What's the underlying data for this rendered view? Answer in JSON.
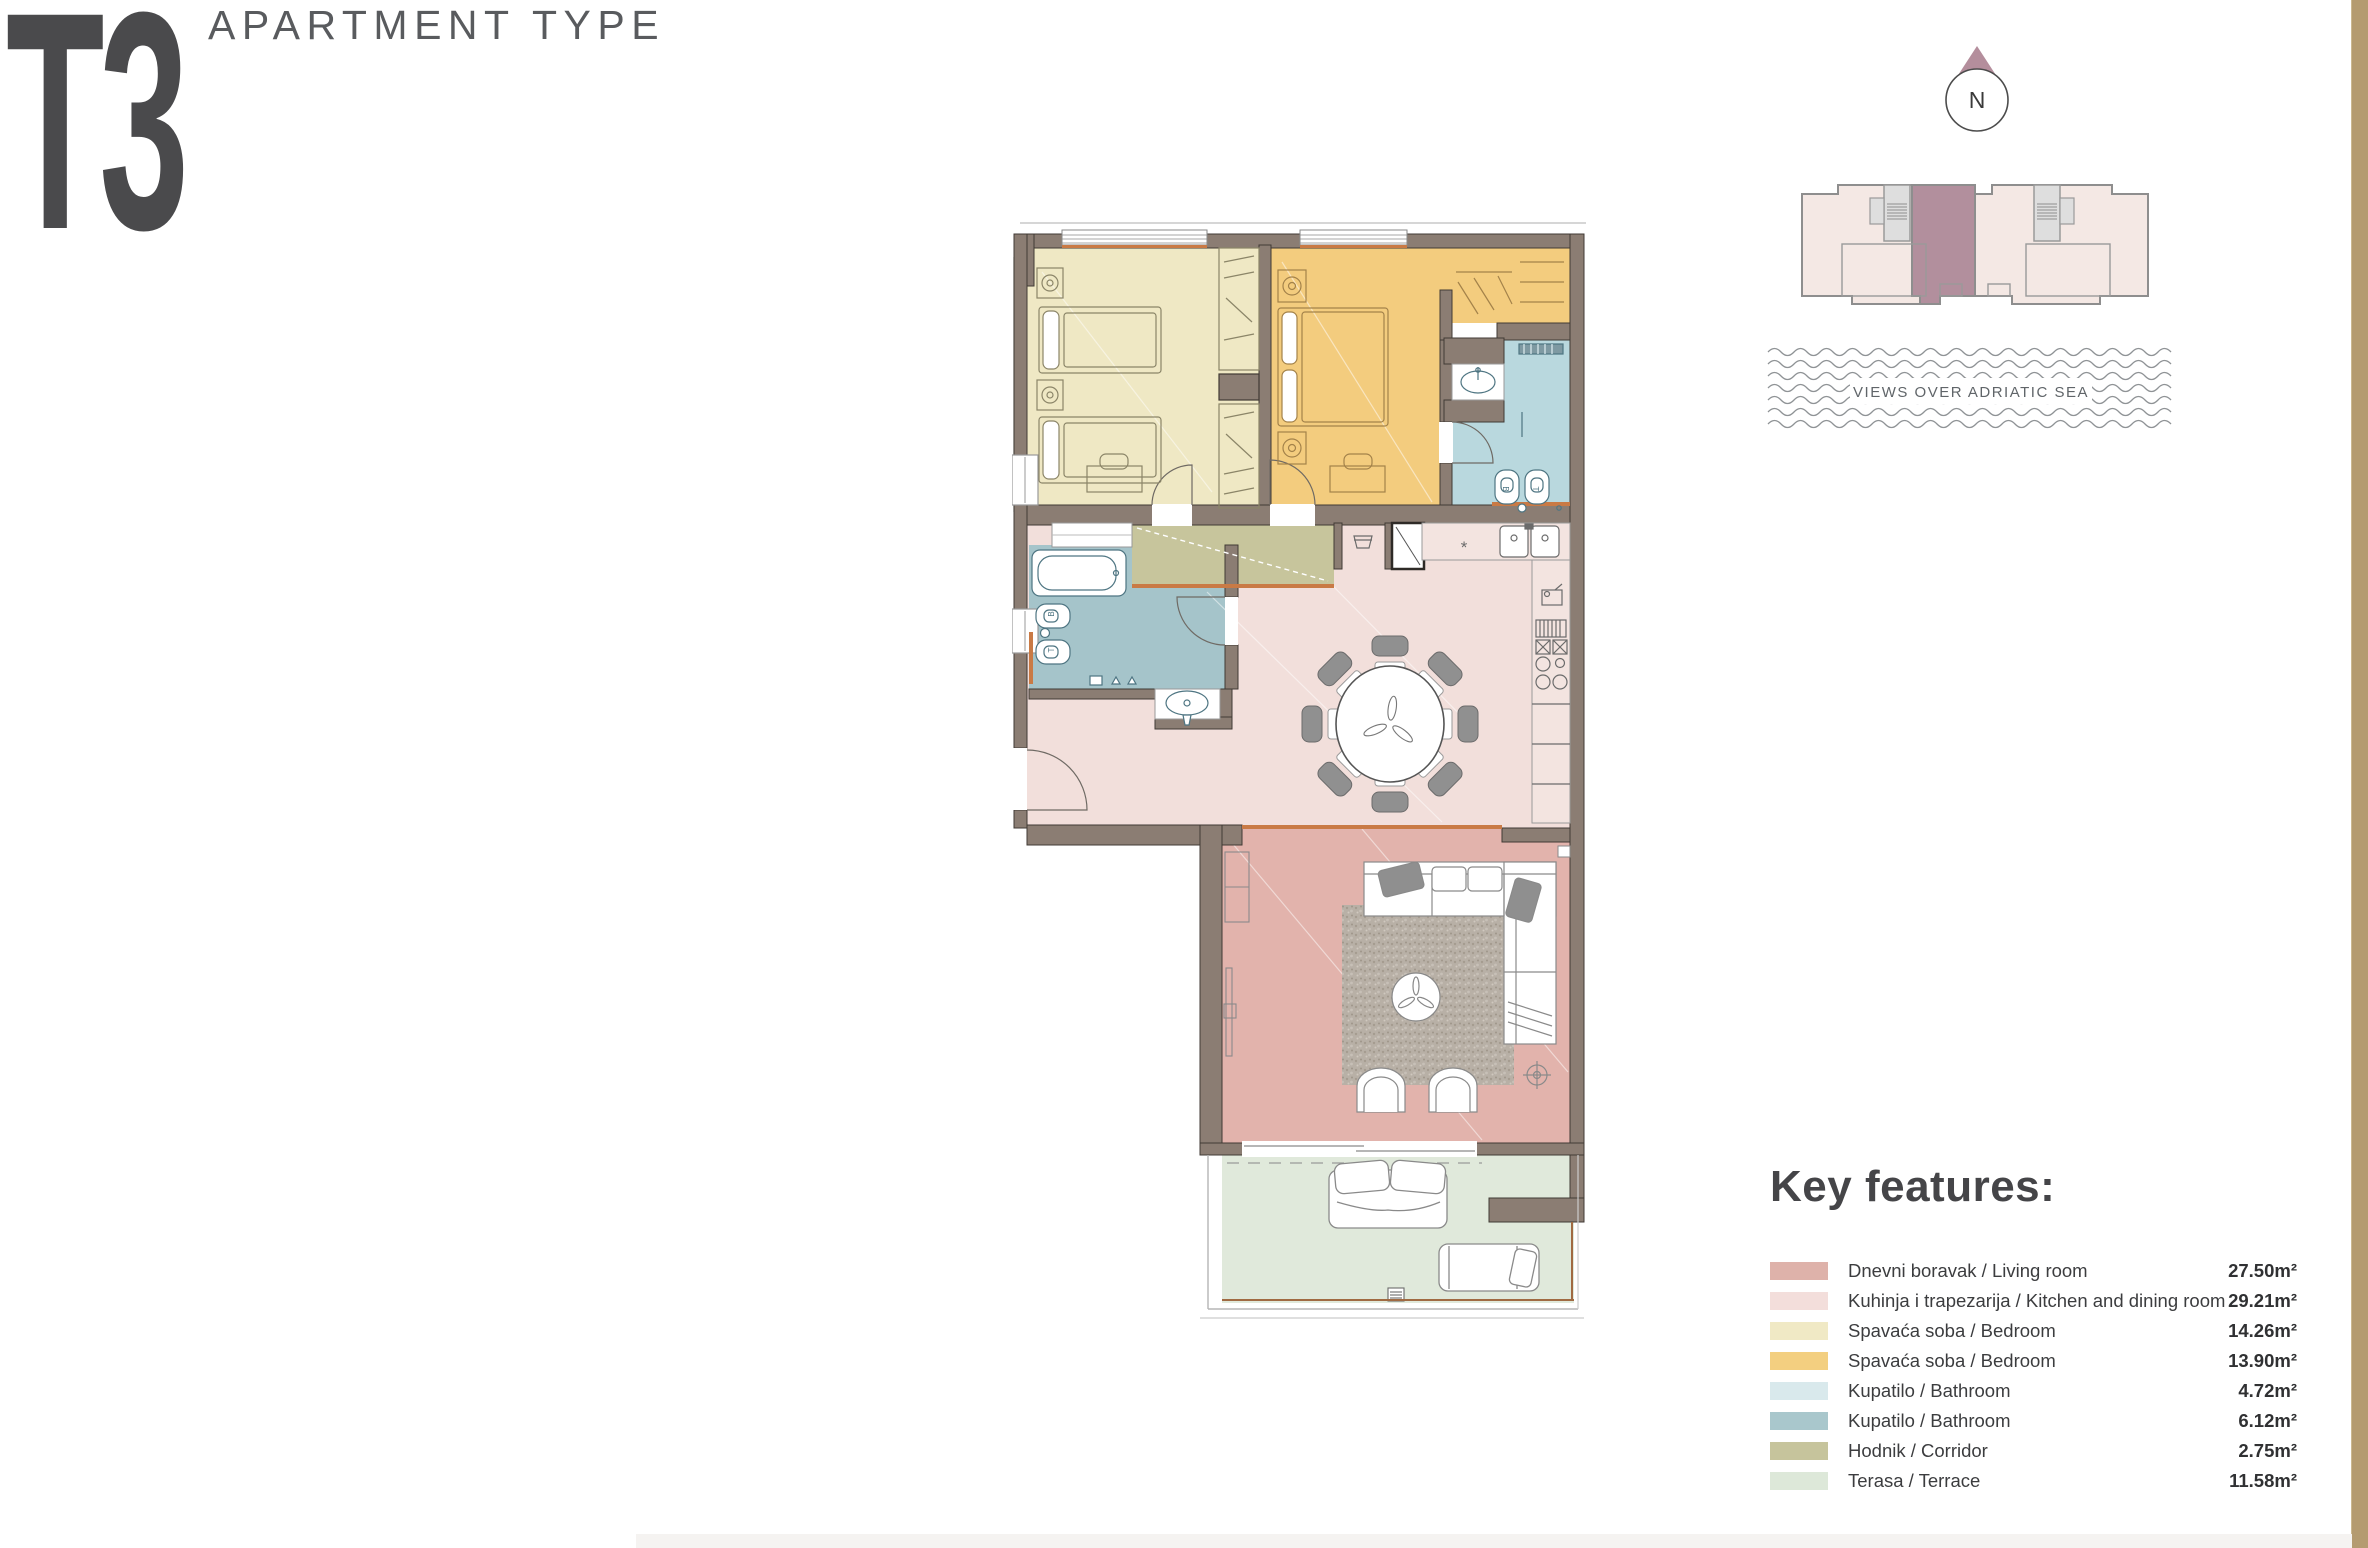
{
  "header": {
    "title": "T3",
    "subtitle": "APARTMENT TYPE"
  },
  "compass": {
    "label": "N"
  },
  "sea": {
    "label": "VIEWS OVER ADRIATIC SEA"
  },
  "key_features": {
    "heading": "Key features:",
    "items": [
      {
        "name": "Dnevni boravak / Living room",
        "area": "27.50m²",
        "color": "#deb2aa"
      },
      {
        "name": "Kuhinja i trapezarija / Kitchen and dining room",
        "area": "29.21m²",
        "color": "#f3dedb"
      },
      {
        "name": "Spavaća soba / Bedroom",
        "area": "14.26m²",
        "color": "#f0e9c5"
      },
      {
        "name": "Spavaća soba / Bedroom",
        "area": "13.90m²",
        "color": "#f3cf80"
      },
      {
        "name": "Kupatilo / Bathroom",
        "area": "4.72m²",
        "color": "#d9e9ec"
      },
      {
        "name": "Kupatilo / Bathroom",
        "area": "6.12m²",
        "color": "#a9c7cc"
      },
      {
        "name": "Hodnik / Corridor",
        "area": "2.75m²",
        "color": "#c6c49c"
      },
      {
        "name": "Terasa / Terrace",
        "area": "11.58m²",
        "color": "#dde8d9"
      }
    ]
  },
  "plan": {
    "room_colors": {
      "living": "#e2b3ac",
      "kitchen": "#f2dfdb",
      "bedroom1": "#efe8c4",
      "bedroom2": "#f3cc7e",
      "bath1": "#b9d8de",
      "bath2": "#a5c4ca",
      "corridor": "#c7c59c",
      "terrace": "#e0e9db",
      "wall": "#8b7d73",
      "accent": "#c97a45",
      "counter": "#f3e4e0"
    },
    "building_colors": {
      "unit": "#f4e8e4",
      "highlight": "#b28f9d",
      "core": "#dedede"
    }
  }
}
